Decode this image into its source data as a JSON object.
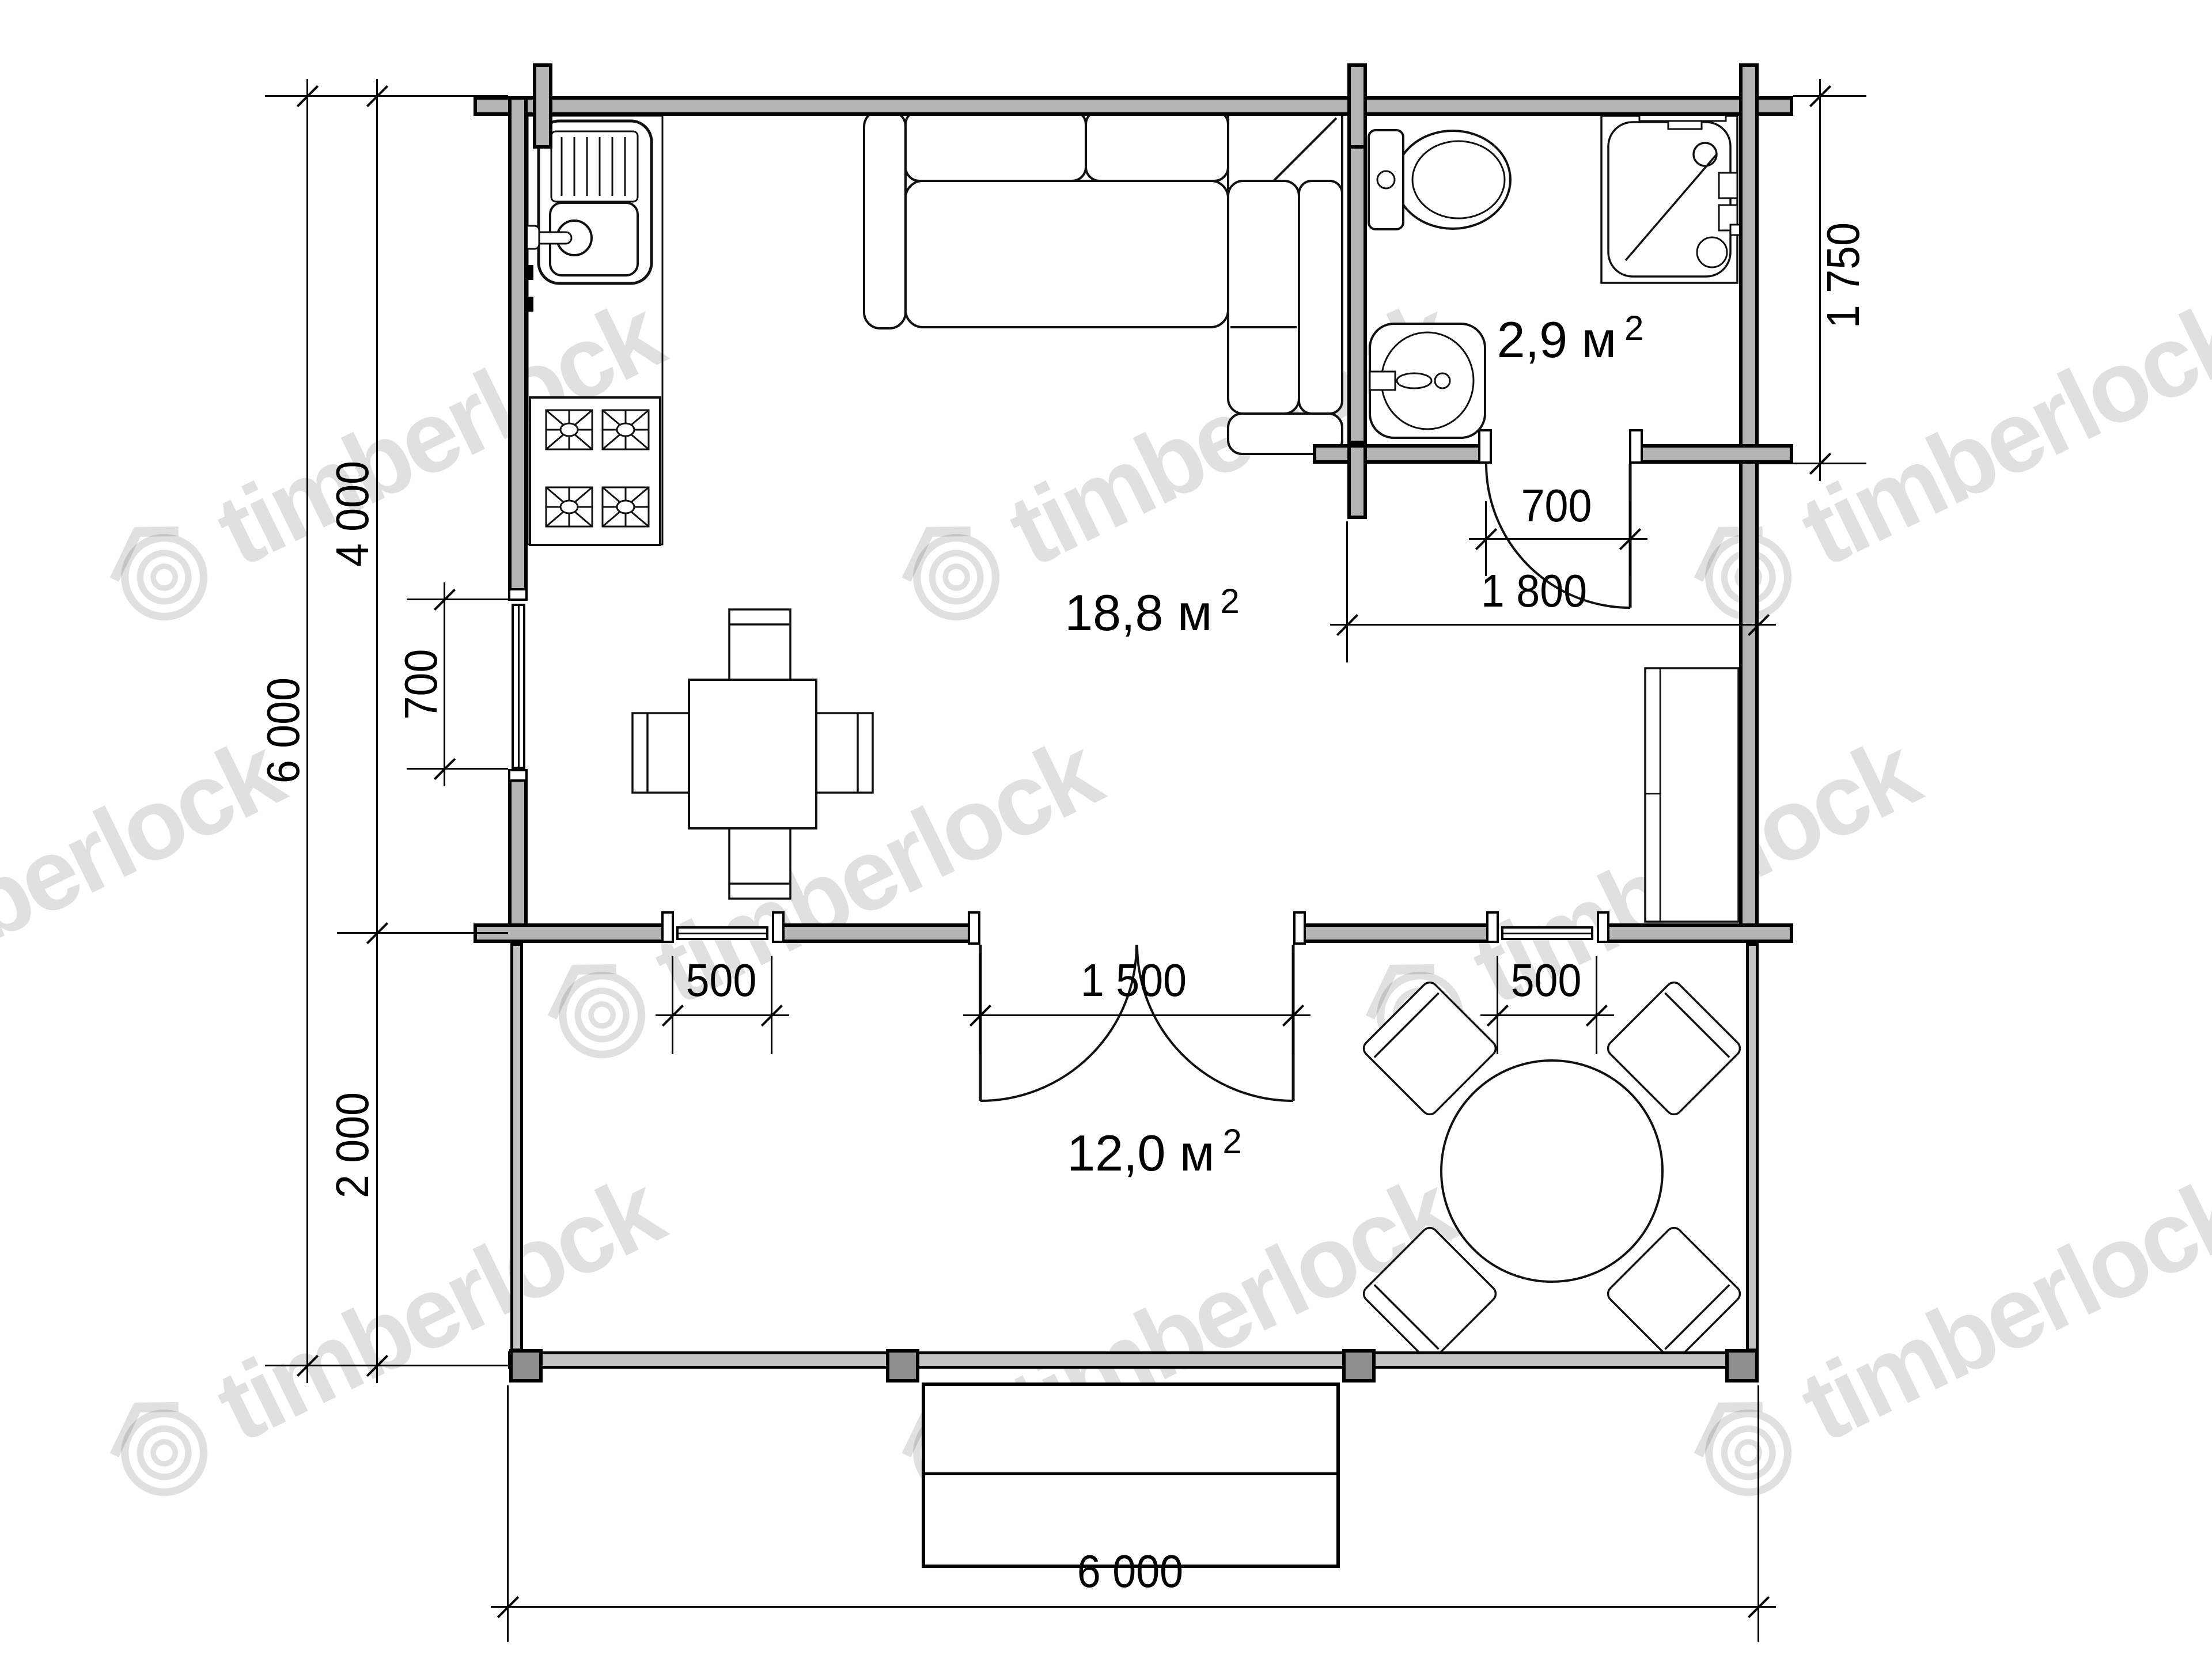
{
  "watermark": {
    "text": "timberlock"
  },
  "rooms": {
    "living": {
      "area": "18,8 м",
      "sup": "2"
    },
    "bathroom": {
      "area": "2,9 м",
      "sup": "2"
    },
    "terrace": {
      "area": "12,0 м",
      "sup": "2"
    }
  },
  "dimensions": {
    "left_total": "6 000",
    "main_depth": "4 000",
    "terrace_depth": "2 000",
    "left_window": "700",
    "bathroom_depth": "1 750",
    "bathroom_door": "700",
    "bathroom_width": "1 800",
    "terrace_window_left": "500",
    "terrace_door": "1 500",
    "terrace_window_right": "500",
    "overall_width": "6 000"
  },
  "colors": {
    "wall_fill": "#b5b5b5",
    "line": "#000000",
    "post_fill": "#8e8e8e",
    "watermark": "rgba(0,0,0,0.12)"
  }
}
